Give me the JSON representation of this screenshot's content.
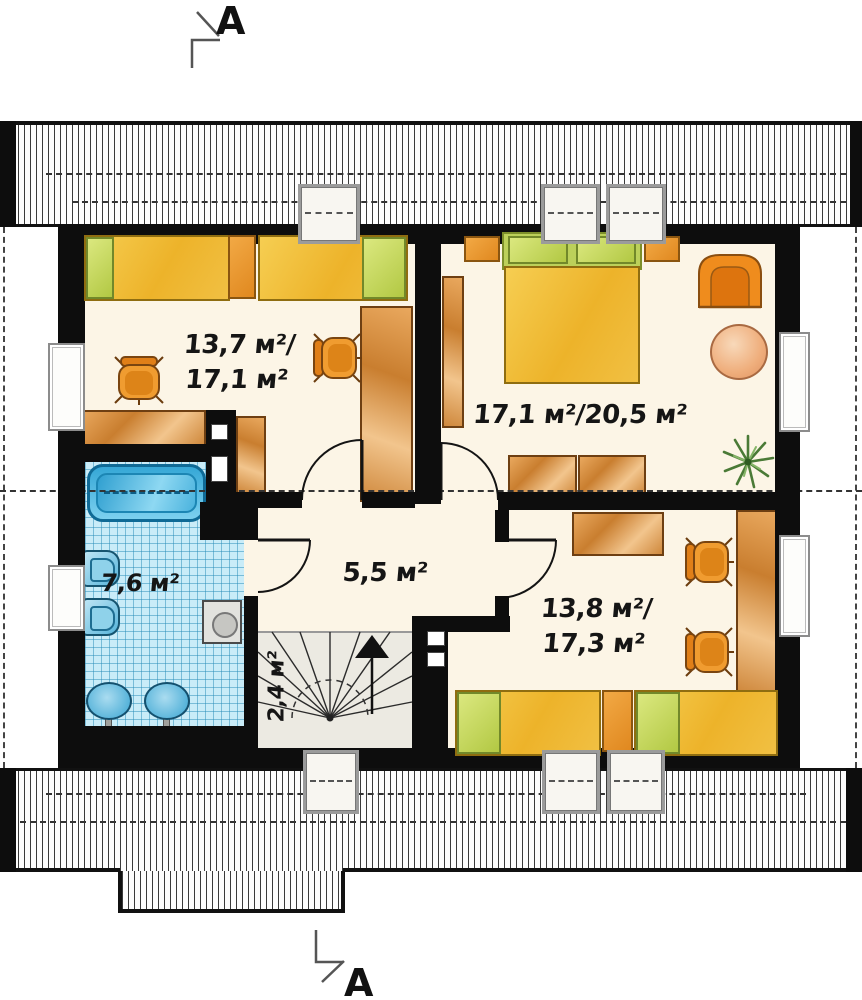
{
  "section_markers": {
    "top": "A",
    "bottom": "A"
  },
  "labels": {
    "child_room_1_line1": "13,7 м²/",
    "child_room_1_line2": "17,1 м²",
    "master_bedroom": "17,1 м²/20,5 м²",
    "bathroom": "7,6 м²",
    "hall": "5,5 м²",
    "staircase": "2,4 м²",
    "child_room_2_line1": "13,8 м²/",
    "child_room_2_line2": "17,3 м²"
  },
  "colors": {
    "wall": "#0d0d0d",
    "floor": "#fcf5e6",
    "tile_blue": "#c9ecf8",
    "wood": "#cf883c",
    "bed_yellow": "#edb32a",
    "pillow_green": "#b2c843",
    "fixture_blue": "#56b4da",
    "chair_orange": "#f09c30"
  }
}
